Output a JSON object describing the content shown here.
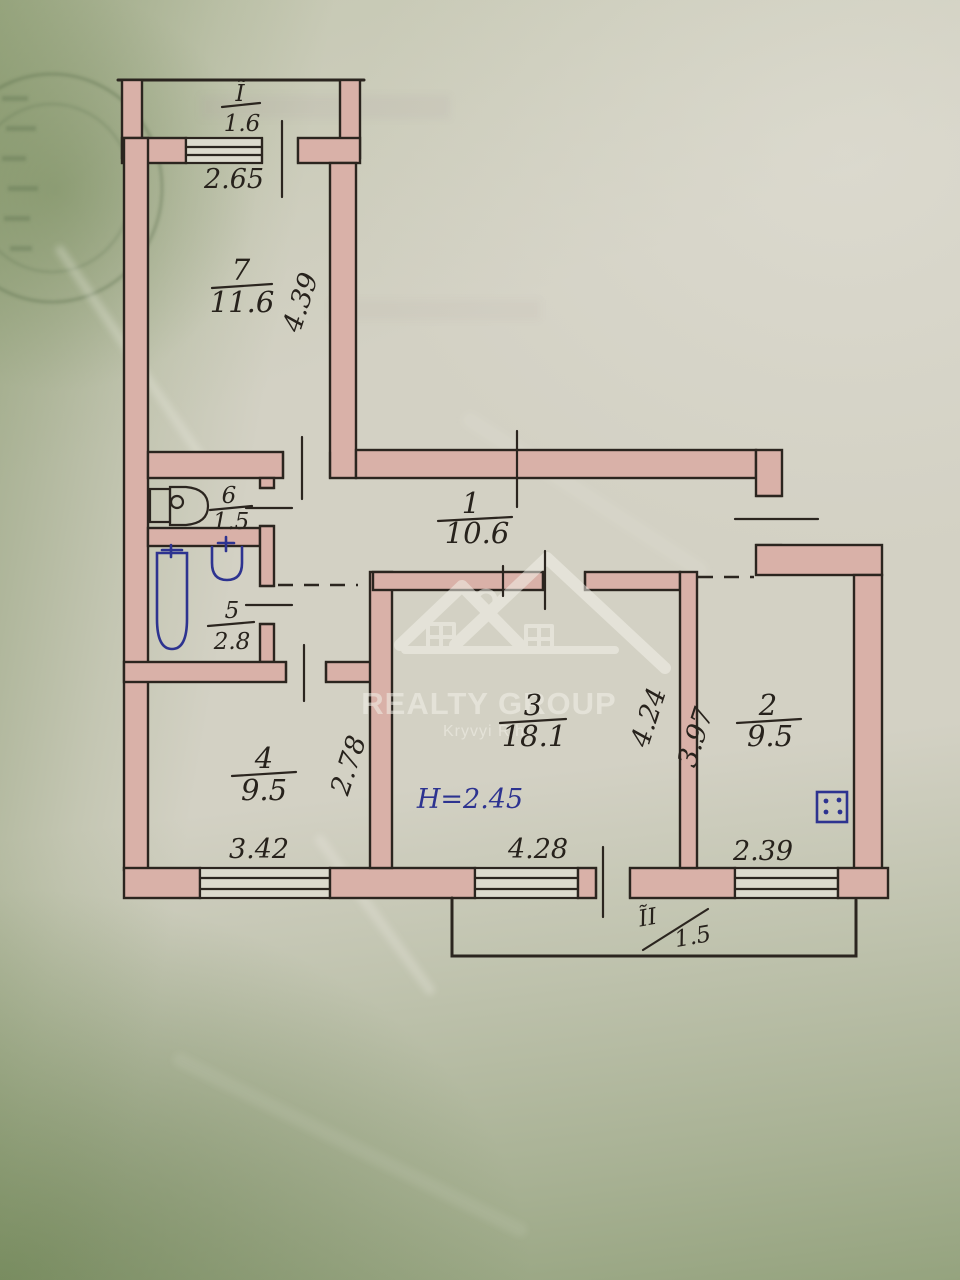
{
  "watermark": {
    "title": "REALTY GROUP",
    "subtitle": "Kryvyi Rih"
  },
  "plan": {
    "height_label": "H=2.45",
    "balconies": [
      {
        "numeral": "Ĩ",
        "area": "1.6"
      },
      {
        "numeral": "ĨI",
        "area": "1.5"
      }
    ],
    "rooms": [
      {
        "number": "1",
        "area": "10.6"
      },
      {
        "number": "2",
        "area": "9.5"
      },
      {
        "number": "3",
        "area": "18.1"
      },
      {
        "number": "4",
        "area": "9.5"
      },
      {
        "number": "5",
        "area": "2.8"
      },
      {
        "number": "6",
        "area": "1.5"
      },
      {
        "number": "7",
        "area": "11.6"
      }
    ],
    "dims": {
      "room7_w": "2.65",
      "room7_d": "4.39",
      "room4_w": "3.42",
      "room4_d": "2.78",
      "room3_w": "4.28",
      "room3_d": "4.24",
      "kitchen_w": "2.39",
      "kitchen_d": "3.97"
    }
  }
}
